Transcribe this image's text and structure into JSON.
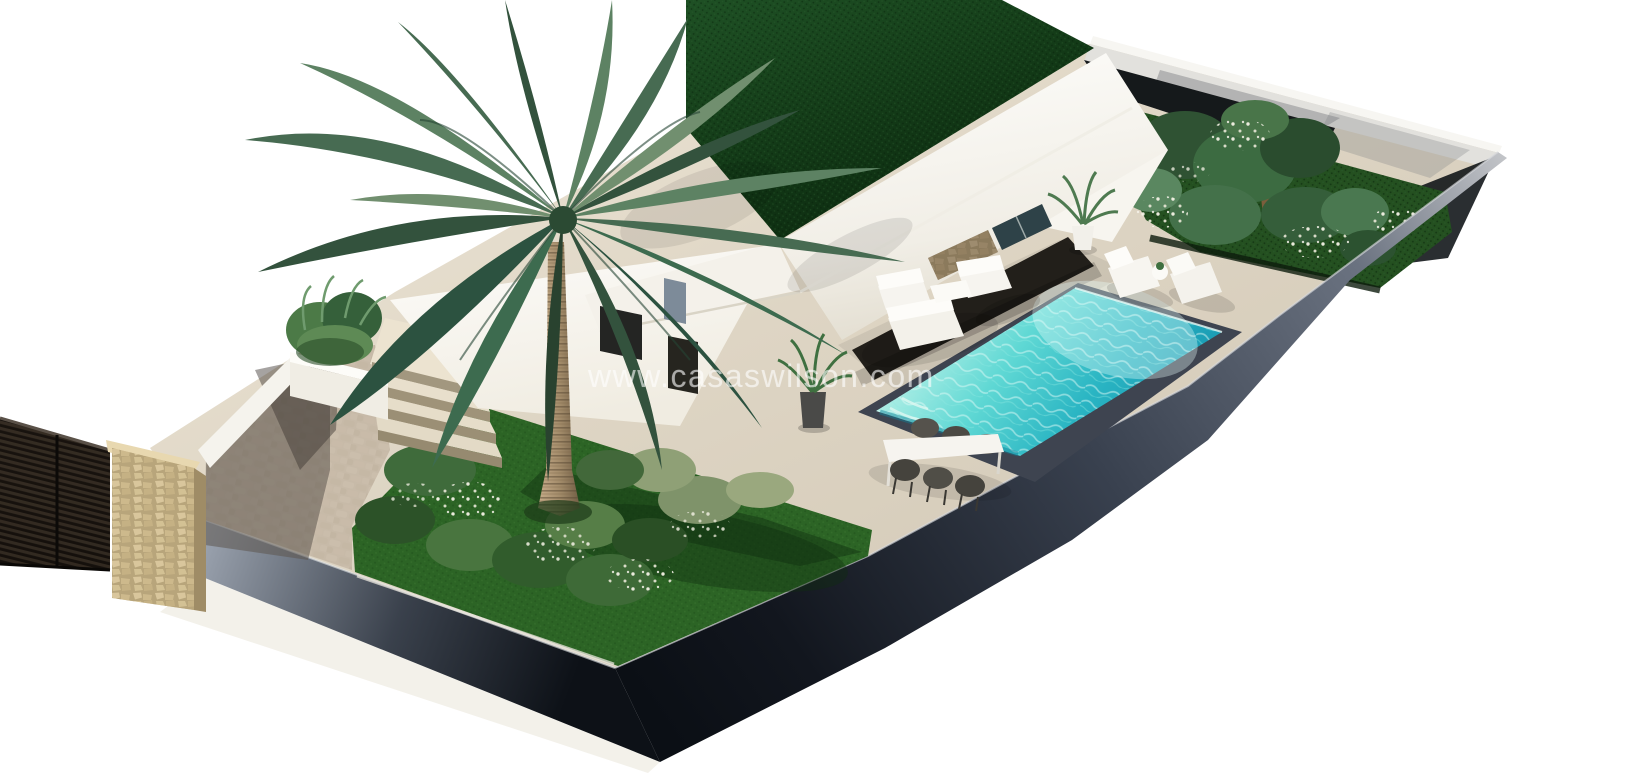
{
  "image": {
    "kind": "3d-architectural-render",
    "subject": "isometric aerial view of a modern white villa plot with palm tree, front lawn, swimming pool, sun terrace and tropical garden",
    "background_color": "#ffffff"
  },
  "watermark": {
    "text": "www.casaswilson.com",
    "visible_fragment": "saswilson.com"
  },
  "palette": {
    "background": "#ffffff",
    "paving_beige": "#ddd4c3",
    "paving_sunlit": "#ece4d2",
    "cobble_shadow": "#6f665e",
    "lawn_green": "#2c6425",
    "roof_grass_dark": "#16391a",
    "garden_green": "#245020",
    "pool_turquoise": "#3ec9c9",
    "pool_deep_teal": "#1795b0",
    "pool_pale_aqua": "#b9f2ea",
    "boundary_wall_dark": "#10151d",
    "boundary_wall_light": "#aeb2b8",
    "gate_dark": "#221d18",
    "pillar_stone_tan": "#d2bf96",
    "villa_white": "#fbfaf7",
    "window_slate_blue": "#7d8b99",
    "opening_dark": "#242523",
    "furniture_white": "#f6f4ef",
    "wicker_dark": "#4c4a44",
    "palm_frond_green": "#476b52",
    "palm_trunk_tan": "#b49a78"
  },
  "scene": {
    "objects": [
      "entry-gate",
      "stone-pillar",
      "driveway",
      "entrance-steps",
      "planter-box",
      "front-lawn",
      "flower-bed",
      "palm-tree",
      "villa-building",
      "green-roof",
      "covered-porch",
      "stone-feature-wall",
      "glass-doors",
      "outdoor-lounge-set",
      "outdoor-dining-set",
      "swimming-pool",
      "sun-loungers",
      "potted-plants",
      "tropical-garden",
      "boundary-walls"
    ]
  }
}
